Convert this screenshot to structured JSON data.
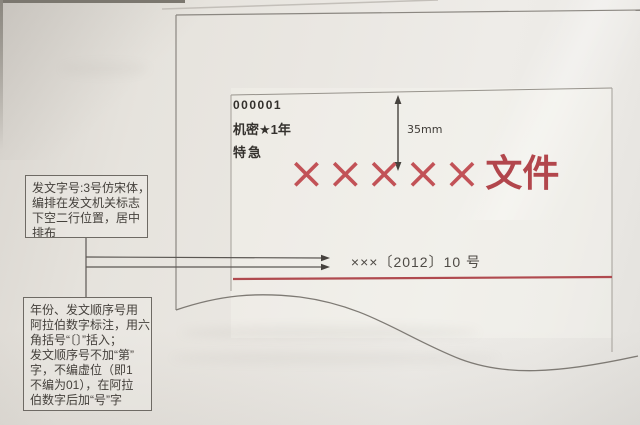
{
  "doc": {
    "serial": "000001",
    "classification": "机密★1年",
    "urgency": "特急",
    "title_x": "×××××",
    "title_suffix": "文件",
    "reference": "×××〔2012〕10 号"
  },
  "measurement": {
    "label": "35mm"
  },
  "annotations": {
    "box1": {
      "lines": [
        "发文字号:3号仿宋体，",
        "编排在发文机关标志",
        "下空二行位置，居中",
        "排布"
      ]
    },
    "box2": {
      "lines": [
        "年份、发文顺序号用",
        "阿拉伯数字标注，用六",
        "角括号“〔〕”括入；",
        "发文顺序号不加“第”",
        "字，不编虚位（即1",
        "不编为01），在阿拉",
        "伯数字后加“号”字"
      ]
    }
  },
  "colors": {
    "accent_red": "#b2464c",
    "separator_red": "#b04a4f",
    "line_gray": "#8b8781",
    "text_dark": "#3a3733",
    "paper": "#eae7e2"
  }
}
